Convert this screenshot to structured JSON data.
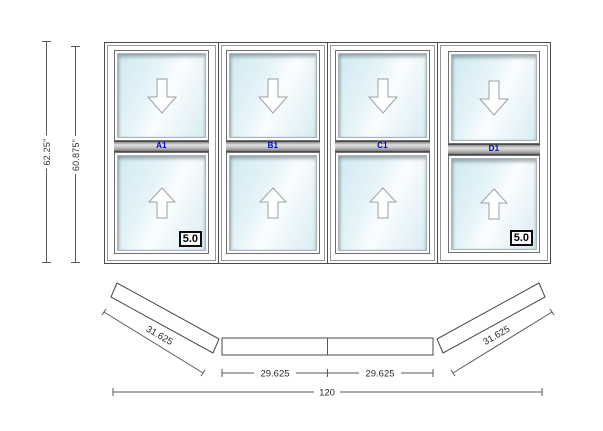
{
  "elevation": {
    "dimensions": {
      "overall_height": "62.25\"",
      "frame_height": "60.875\""
    },
    "units": [
      {
        "label": "A1",
        "rating": "5.0"
      },
      {
        "label": "B1"
      },
      {
        "label": "C1"
      },
      {
        "label": "D1",
        "rating": "5.0"
      }
    ]
  },
  "plan": {
    "dimensions": {
      "left_projection": "31.625",
      "center_left": "29.625",
      "center_right": "29.625",
      "right_projection": "31.625",
      "overall_width": "120"
    }
  },
  "colors": {
    "line": "#4a4a4a",
    "unit_label": "#0000cc",
    "dim_text": "#333333",
    "glass_tint": "#d7ecf3"
  }
}
